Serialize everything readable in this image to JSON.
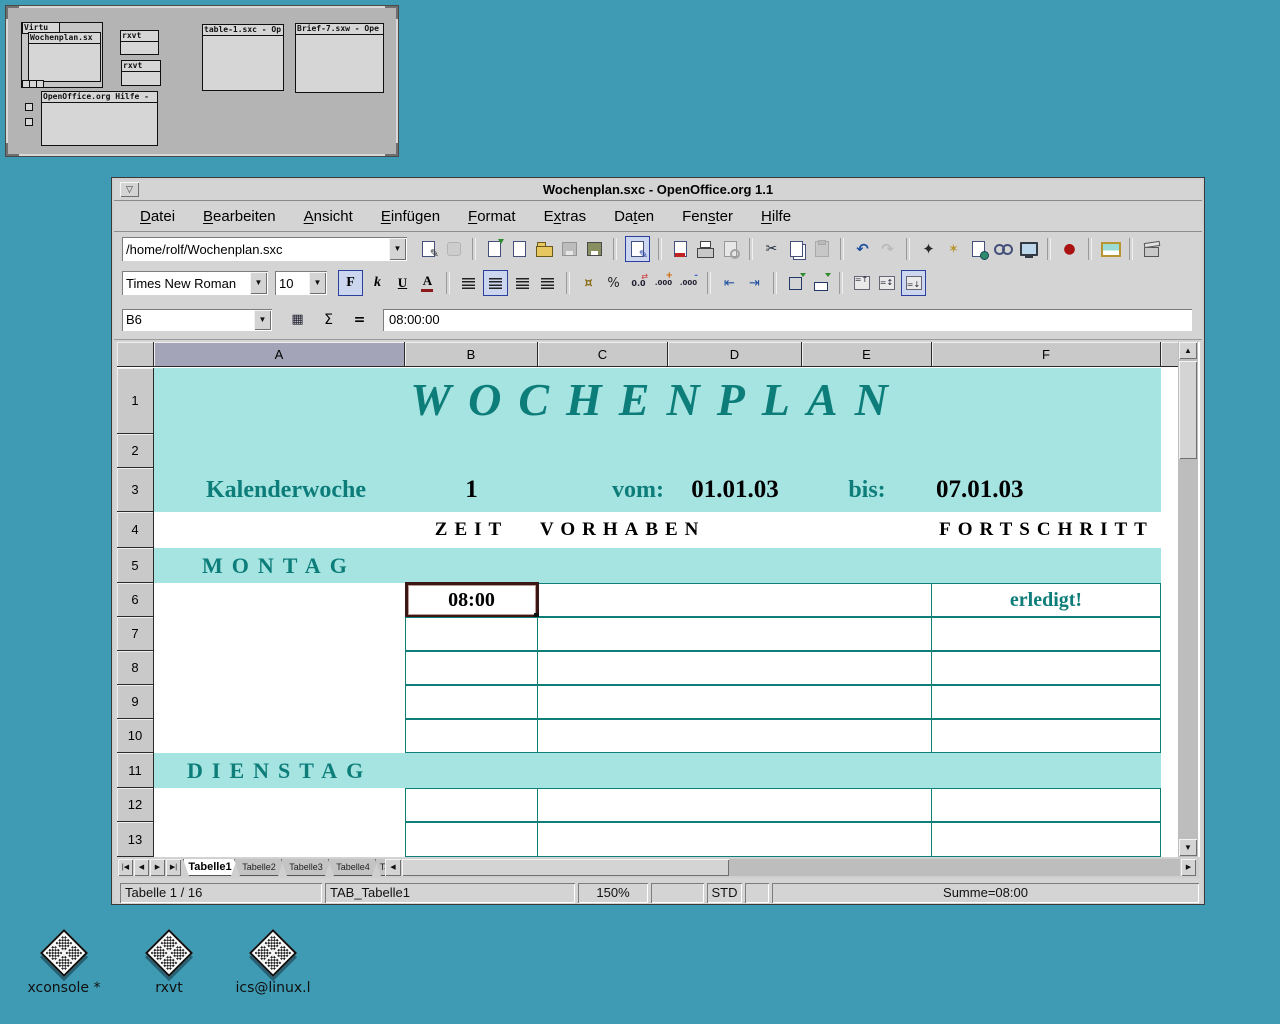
{
  "colors": {
    "desktop_bg": "#3f9ab3",
    "window_gray": "#d4d4d4",
    "band_cyan": "#a6e4e2",
    "teal_text": "#0d7d7a",
    "grid_line": "#0e7f78",
    "selection_border": "#3a1715",
    "pressed_icon_bg": "#ccd6ee"
  },
  "pager": {
    "windows": {
      "virtu": "Virtu",
      "wochenplan": "Wochenplan.sx",
      "rxvt1": "rxvt",
      "rxvt2": "rxvt",
      "table1": "table-1.sxc - Op",
      "brief7": "Brief-7.sxw - Ope",
      "hilfe": "OpenOffice.org Hilfe -"
    }
  },
  "window": {
    "title": "Wochenplan.sxc - OpenOffice.org 1.1",
    "menu": [
      {
        "pre": "",
        "acc": "D",
        "post": "atei"
      },
      {
        "pre": "",
        "acc": "B",
        "post": "earbeiten"
      },
      {
        "pre": "",
        "acc": "A",
        "post": "nsicht"
      },
      {
        "pre": "",
        "acc": "E",
        "post": "infügen"
      },
      {
        "pre": "",
        "acc": "F",
        "post": "ormat"
      },
      {
        "pre": "E",
        "acc": "x",
        "post": "tras"
      },
      {
        "pre": "Da",
        "acc": "t",
        "post": "en"
      },
      {
        "pre": "Fen",
        "acc": "s",
        "post": "ter"
      },
      {
        "pre": "",
        "acc": "H",
        "post": "ilfe"
      }
    ],
    "toolbar1": {
      "url": "/home/rolf/Wochenplan.sxc",
      "icons": [
        {
          "n": "edit-url"
        },
        {
          "n": "stop-loading",
          "disabled": true
        },
        {
          "n": "sep"
        },
        {
          "n": "new-document"
        },
        {
          "n": "blank-document"
        },
        {
          "n": "open-document"
        },
        {
          "n": "save-document",
          "disabled": true
        },
        {
          "n": "save-as"
        },
        {
          "n": "sep"
        },
        {
          "n": "edit-file",
          "pressed": true
        },
        {
          "n": "sep"
        },
        {
          "n": "export-pdf"
        },
        {
          "n": "print"
        },
        {
          "n": "page-preview",
          "disabled": true
        },
        {
          "n": "sep"
        },
        {
          "n": "cut"
        },
        {
          "n": "copy"
        },
        {
          "n": "paste",
          "disabled": true
        },
        {
          "n": "sep"
        },
        {
          "n": "undo"
        },
        {
          "n": "redo",
          "disabled": true
        },
        {
          "n": "sep"
        },
        {
          "n": "navigator"
        },
        {
          "n": "magic-wand"
        },
        {
          "n": "insert-document"
        },
        {
          "n": "hyperlink"
        },
        {
          "n": "show-draw"
        },
        {
          "n": "sep"
        },
        {
          "n": "record-changes"
        },
        {
          "n": "sep"
        },
        {
          "n": "gallery"
        },
        {
          "n": "sep"
        },
        {
          "n": "stamp-box"
        }
      ]
    },
    "toolbar2": {
      "font_name": "Times New Roman",
      "font_size": "10",
      "icons": [
        {
          "n": "bold",
          "pressed": true
        },
        {
          "n": "italic"
        },
        {
          "n": "underline"
        },
        {
          "n": "font-color"
        },
        {
          "n": "sep"
        },
        {
          "n": "align-left"
        },
        {
          "n": "align-center",
          "pressed": true
        },
        {
          "n": "align-right"
        },
        {
          "n": "justify"
        },
        {
          "n": "sep"
        },
        {
          "n": "currency"
        },
        {
          "n": "percent"
        },
        {
          "n": "format-standard"
        },
        {
          "n": "add-decimal"
        },
        {
          "n": "delete-decimal"
        },
        {
          "n": "sep"
        },
        {
          "n": "indent-less"
        },
        {
          "n": "indent-more"
        },
        {
          "n": "sep"
        },
        {
          "n": "borders"
        },
        {
          "n": "background-color"
        },
        {
          "n": "sep"
        },
        {
          "n": "valign-top"
        },
        {
          "n": "valign-center"
        },
        {
          "n": "valign-bottom",
          "pressed": true
        }
      ]
    },
    "formulabar": {
      "name_box": "B6",
      "icons": [
        {
          "n": "function-autopilot"
        },
        {
          "n": "sum"
        },
        {
          "n": "function"
        }
      ],
      "input": "08:00:00"
    }
  },
  "sheet": {
    "columns": [
      "A",
      "B",
      "C",
      "D",
      "E",
      "F"
    ],
    "highlighted_column": "A",
    "rows": [
      "1",
      "2",
      "3",
      "4",
      "5",
      "6",
      "7",
      "8",
      "9",
      "10",
      "11",
      "12",
      "13"
    ],
    "cells": {
      "title": "WOCHENPLAN",
      "kalenderwoche_label": "Kalenderwoche",
      "kalenderwoche_value": "1",
      "vom_label": "vom:",
      "vom_value": "01.01.03",
      "bis_label": "bis:",
      "bis_value": "07.01.03",
      "zeit_header": "ZEIT",
      "vorhaben_header": "VORHABEN",
      "fortschritt_header": "FORTSCHRITT",
      "montag": "MONTAG",
      "dienstag": "DIENSTAG"
    },
    "grid_rows": [
      {
        "row": 6,
        "zeit": "08:00",
        "vorhaben": "",
        "fortschritt": "erledigt!",
        "selected": true
      },
      {
        "row": 7,
        "zeit": "",
        "vorhaben": "",
        "fortschritt": ""
      },
      {
        "row": 8,
        "zeit": "",
        "vorhaben": "",
        "fortschritt": ""
      },
      {
        "row": 9,
        "zeit": "",
        "vorhaben": "",
        "fortschritt": ""
      },
      {
        "row": 10,
        "zeit": "",
        "vorhaben": "",
        "fortschritt": ""
      },
      {
        "row": 12,
        "zeit": "",
        "vorhaben": "",
        "fortschritt": ""
      },
      {
        "row": 13,
        "zeit": "",
        "vorhaben": "",
        "fortschritt": ""
      }
    ],
    "tabs": [
      "Tabelle1",
      "Tabelle2",
      "Tabelle3",
      "Tabelle4",
      "Tab"
    ],
    "active_tab": "Tabelle1"
  },
  "statusbar": {
    "items": [
      "Tabelle 1 / 16",
      "TAB_Tabelle1",
      "150%",
      "",
      "STD",
      "",
      "Summe=08:00"
    ]
  },
  "desktop_icons": [
    {
      "label": "xconsole *"
    },
    {
      "label": "rxvt"
    },
    {
      "label": "ics@linux.l"
    }
  ]
}
